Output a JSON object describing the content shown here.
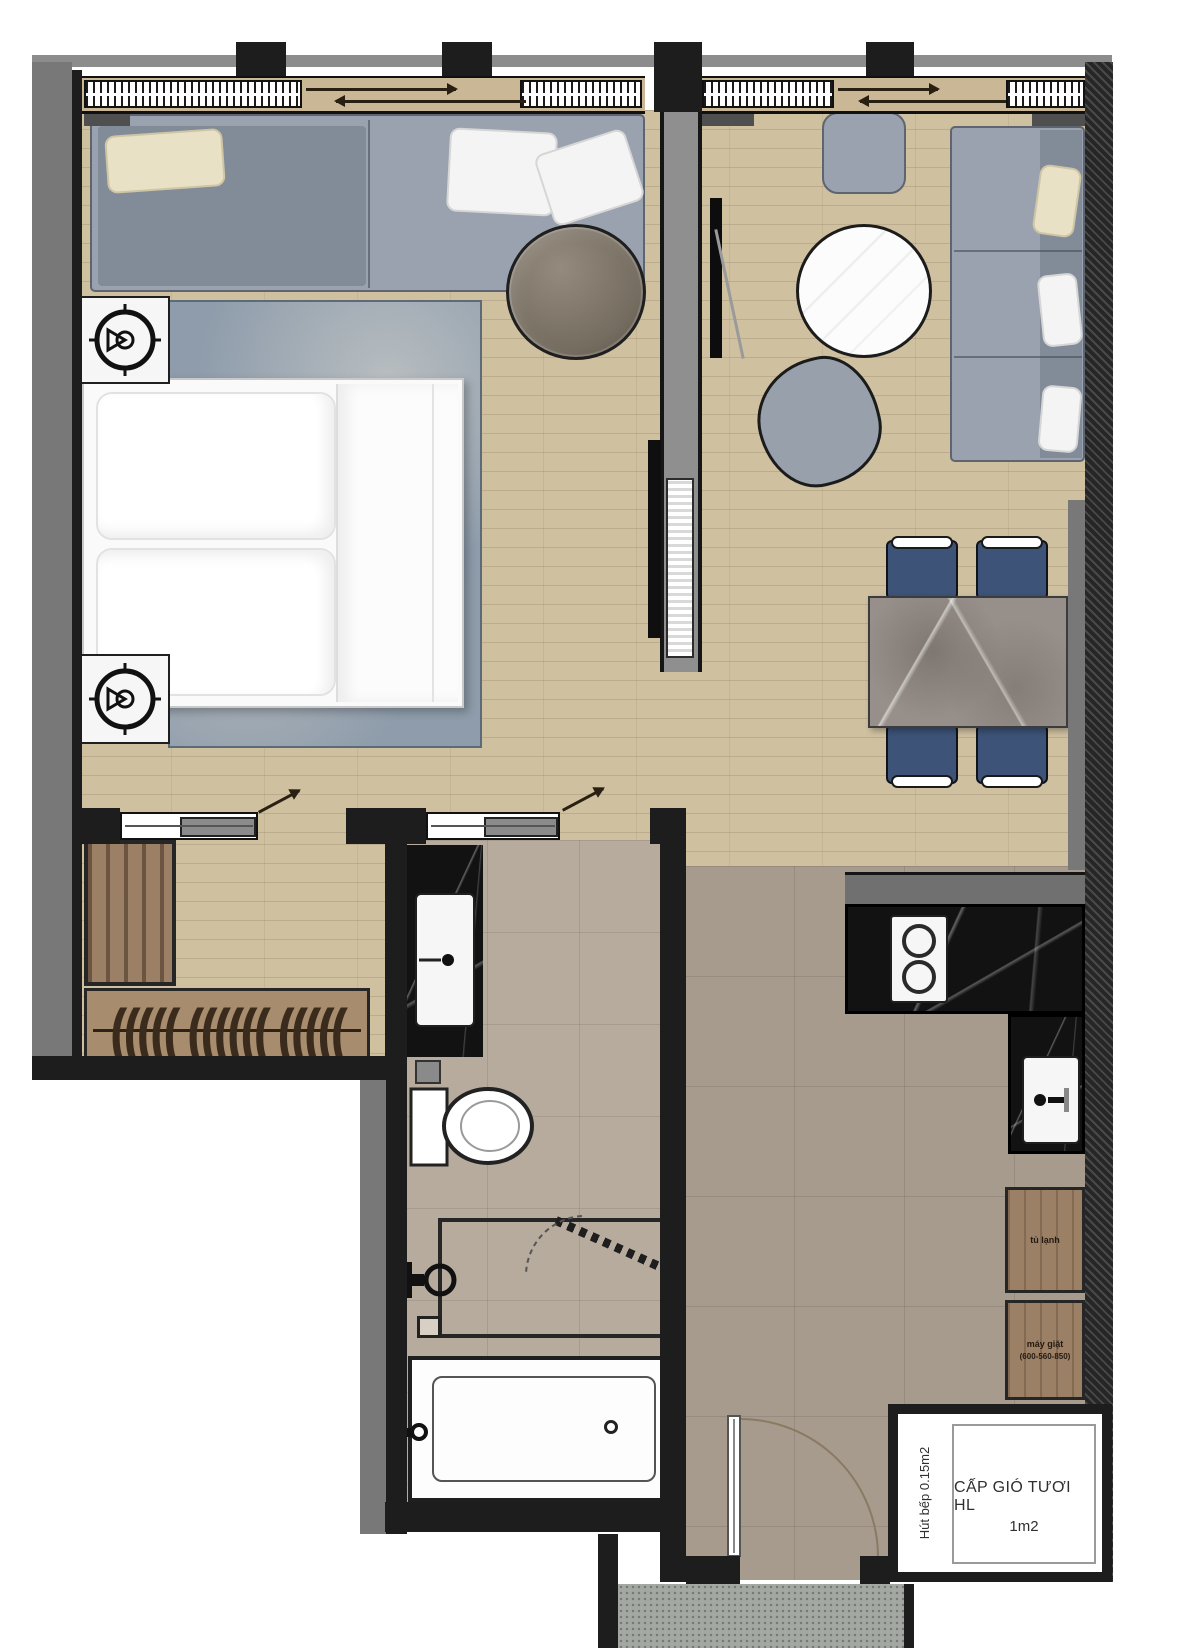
{
  "labels": {
    "fresh_air_line1": "CẤP GIÓ TƯƠI HL",
    "fresh_air_line2": "1m2",
    "range_hood": "Hút bếp 0.15m2",
    "fridge_cabinet": "tủ lạnh",
    "washer_name": "máy giặt",
    "washer_dims": "(600-560-850)"
  },
  "colors": {
    "wall": "#1d1d1d",
    "wall_gray": "#787878",
    "wood_floor": "#cfc0a0",
    "kitchen_tile": "#a69b8d",
    "bath_tile": "#b6ab9d",
    "rug": "#8e9cab",
    "sofa": "#99a2ae",
    "dining_chair": "#3d5377",
    "counter_marble": "#121212",
    "dining_table_marble": "#97908a",
    "cabinet_wood": "#9b8066",
    "pillow_cream": "#e9e1c6"
  },
  "decor": {
    "hangers": "(((((  ((((((  ((((("
  }
}
